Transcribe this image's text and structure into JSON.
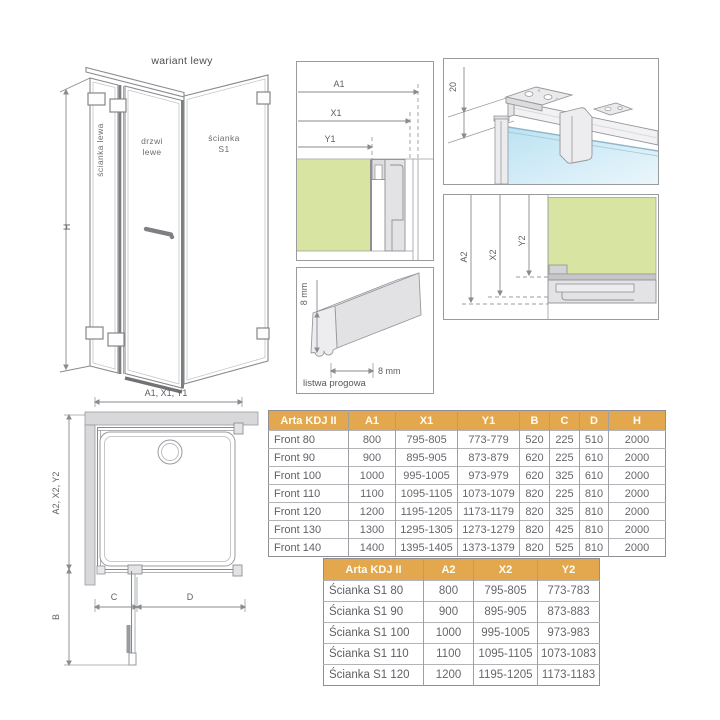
{
  "colors": {
    "accent_header": "#E3A84E",
    "glass_green": "#D8E4A2",
    "glass_blue": "#BCE2F3",
    "profile_gray": "#E3E3E5",
    "line_gray": "#8A8B8F"
  },
  "drawings": {
    "isometric": {
      "title": "wariant lewy",
      "wall_left_label": "ścianka lewa",
      "door_label_line1": "drzwi",
      "door_label_line2": "lewe",
      "s1_label_line1": "ścianka",
      "s1_label_line2": "S1",
      "height_dim": "H"
    },
    "plan": {
      "top_dim": "A1, X1, Y1",
      "left_dim": "A2, X2, Y2",
      "b_dim": "B",
      "c_dim": "C",
      "d_dim": "D"
    },
    "section_horizontal": {
      "a1": "A1",
      "x1": "X1",
      "y1": "Y1"
    },
    "threshold": {
      "height_dim": "8 mm",
      "width_dim": "8 mm",
      "caption": "listwa progowa"
    },
    "top_bracket": {
      "offset_dim": "20"
    },
    "section_vertical": {
      "a2": "A2",
      "x2": "X2",
      "y2": "Y2"
    }
  },
  "tables": {
    "front": {
      "header": [
        "Arta KDJ II",
        "A1",
        "X1",
        "Y1",
        "B",
        "C",
        "D",
        "H"
      ],
      "rows": [
        [
          "Front 80",
          "800",
          "795-805",
          "773-779",
          "520",
          "225",
          "510",
          "2000"
        ],
        [
          "Front 90",
          "900",
          "895-905",
          "873-879",
          "620",
          "225",
          "610",
          "2000"
        ],
        [
          "Front 100",
          "1000",
          "995-1005",
          "973-979",
          "620",
          "325",
          "610",
          "2000"
        ],
        [
          "Front 110",
          "1100",
          "1095-1105",
          "1073-1079",
          "820",
          "225",
          "810",
          "2000"
        ],
        [
          "Front 120",
          "1200",
          "1195-1205",
          "1173-1179",
          "820",
          "325",
          "810",
          "2000"
        ],
        [
          "Front 130",
          "1300",
          "1295-1305",
          "1273-1279",
          "820",
          "425",
          "810",
          "2000"
        ],
        [
          "Front 140",
          "1400",
          "1395-1405",
          "1373-1379",
          "820",
          "525",
          "810",
          "2000"
        ]
      ]
    },
    "side": {
      "header": [
        "Arta KDJ II",
        "A2",
        "X2",
        "Y2"
      ],
      "rows": [
        [
          "Ścianka S1 80",
          "800",
          "795-805",
          "773-783"
        ],
        [
          "Ścianka S1 90",
          "900",
          "895-905",
          "873-883"
        ],
        [
          "Ścianka S1 100",
          "1000",
          "995-1005",
          "973-983"
        ],
        [
          "Ścianka S1 110",
          "1100",
          "1095-1105",
          "1073-1083"
        ],
        [
          "Ścianka S1 120",
          "1200",
          "1195-1205",
          "1173-1183"
        ]
      ]
    }
  }
}
